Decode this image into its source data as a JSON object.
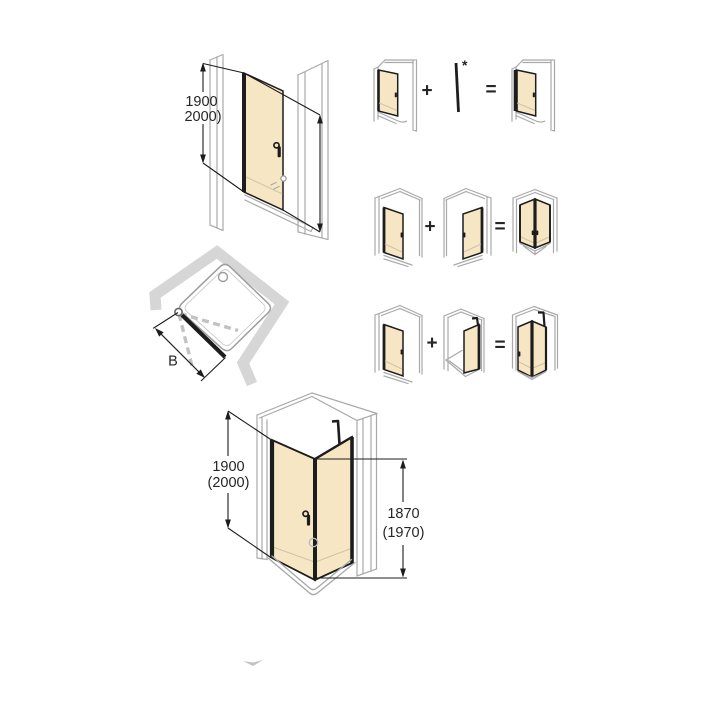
{
  "palette": {
    "line_black": "#1d1d1d",
    "wall_gray": "#a9a9a9",
    "wall_fill": "#d6d6d6",
    "glass_beige": "#f7e6c3",
    "glass_seam": "#cfc3a9",
    "dash_gray": "#c2c2c2",
    "text_color": "#262626",
    "watermark_gray": "#a8a8a8"
  },
  "niche_front_view": {
    "height_dim_line1": "1900",
    "height_dim_line2": "2000)"
  },
  "plan_view": {
    "width_dim_label": "B"
  },
  "combo_rows": {
    "plus": "+",
    "equals": "=",
    "asterisk": "*"
  },
  "corner_view": {
    "height_dim_line1": "1900",
    "height_dim_line2": "(2000)",
    "glass_height_dim_line1": "1870",
    "glass_height_dim_line2": "(1970)"
  }
}
